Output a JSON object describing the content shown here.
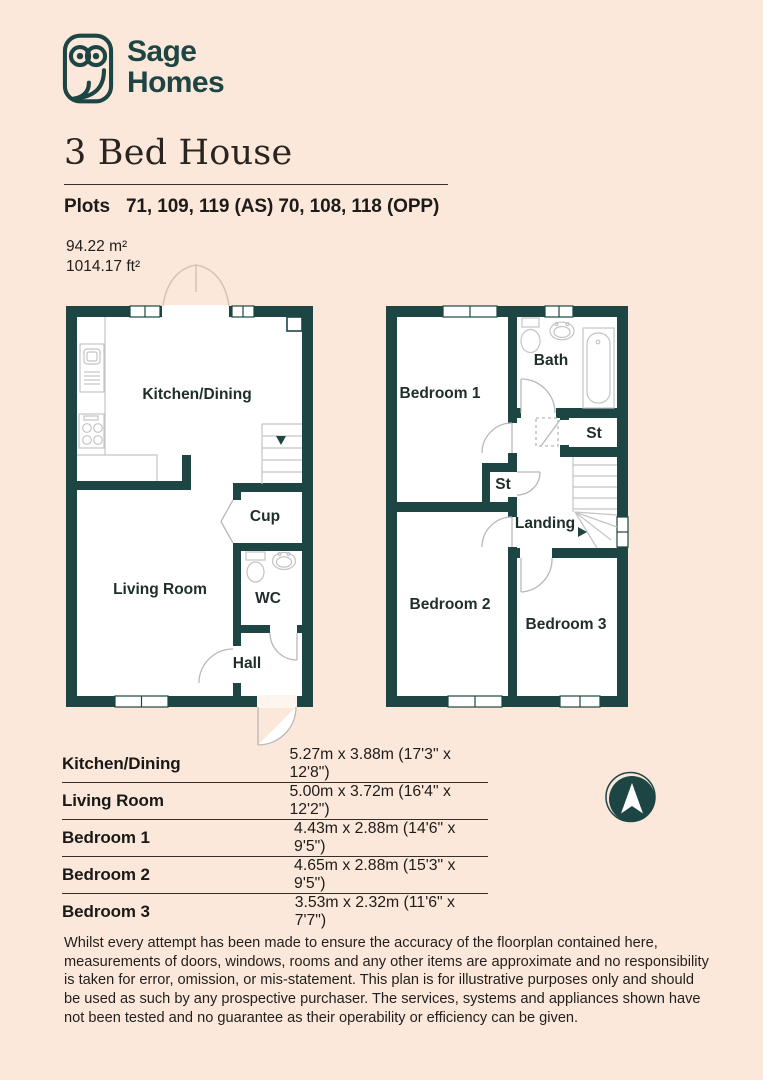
{
  "page": {
    "background": "#fce8da",
    "accent": "#1c4543"
  },
  "logo": {
    "brand_line1": "Sage",
    "brand_line2": "Homes"
  },
  "header": {
    "title": "3 Bed House",
    "plots_label": "Plots",
    "plots_value": "71, 109, 119 (AS) 70, 108, 118 (OPP)",
    "area_m2": "94.22 m²",
    "area_ft2": "1014.17 ft²"
  },
  "floorplans": {
    "ground": {
      "kitchen_dining": "Kitchen/Dining",
      "cup": "Cup",
      "living_room": "Living Room",
      "wc": "WC",
      "hall": "Hall"
    },
    "first": {
      "bedroom1": "Bedroom 1",
      "bath": "Bath",
      "st_upper": "St",
      "st_lower": "St",
      "landing": "Landing",
      "bedroom2": "Bedroom 2",
      "bedroom3": "Bedroom 3"
    }
  },
  "dimensions_table": {
    "rows": [
      {
        "name": "Kitchen/Dining",
        "value": "5.27m x 3.88m (17'3\" x 12'8\")"
      },
      {
        "name": "Living Room",
        "value": "5.00m x 3.72m (16'4\" x 12'2\")"
      },
      {
        "name": "Bedroom 1",
        "value": "4.43m x 2.88m (14'6\" x 9'5\")"
      },
      {
        "name": "Bedroom 2",
        "value": "4.65m x 2.88m (15'3\" x 9'5\")"
      },
      {
        "name": "Bedroom 3",
        "value": "3.53m x 2.32m (11'6\" x 7'7\")"
      }
    ]
  },
  "compass": {
    "direction": "N"
  },
  "disclaimer": "Whilst every attempt has been made to ensure the accuracy of the floorplan contained here, measurements of doors, windows, rooms and any other items are approximate and no responsibility is taken for error, omission, or mis-statement. This plan is for illustrative purposes only and should be used as such by any prospective purchaser. The services, systems and appliances shown have not been tested and no guarantee as their operability or efficiency can be given."
}
